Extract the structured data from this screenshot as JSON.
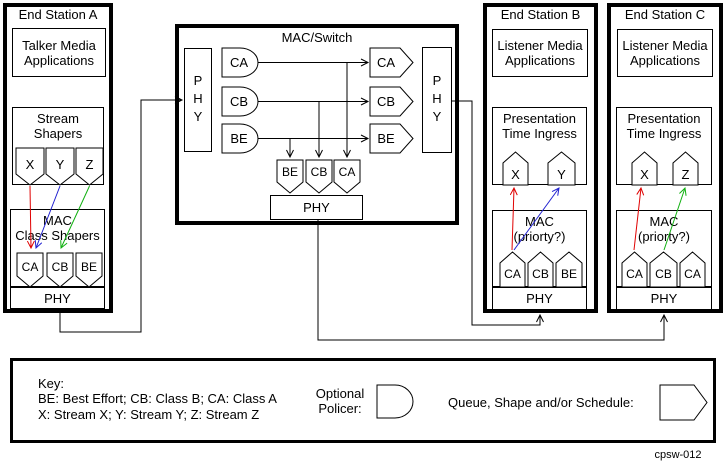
{
  "figure_id": "cpsw-012",
  "colors": {
    "line": "#000000",
    "stream_x_arrow": "#e00000",
    "stream_y_arrow": "#2020d0",
    "stream_z_arrow": "#10b010"
  },
  "station_a": {
    "title": "End Station A",
    "app_lines": [
      "Talker Media",
      "Applications"
    ],
    "shaper_lines": [
      "Stream",
      "Shapers"
    ],
    "streams": [
      "X",
      "Y",
      "Z"
    ],
    "mac_lines": [
      "MAC",
      "Class Shapers"
    ],
    "classes": [
      "CA",
      "CB",
      "BE"
    ],
    "phy_label": "PHY"
  },
  "switch": {
    "title": "MAC/Switch",
    "phy_left_label": "PHY",
    "phy_right_label": "PHY",
    "phy_bottom_label": "PHY",
    "policers": [
      "CA",
      "CB",
      "BE"
    ],
    "right_queues": [
      "CA",
      "CB",
      "BE"
    ],
    "bottom_queues": [
      "BE",
      "CB",
      "CA"
    ]
  },
  "station_b": {
    "title": "End Station B",
    "app_lines": [
      "Listener Media",
      "Applications"
    ],
    "ingress_lines": [
      "Presentation",
      "Time Ingress"
    ],
    "streams": [
      "X",
      "Y"
    ],
    "mac_lines": [
      "MAC",
      "(priorty?)"
    ],
    "classes": [
      "CA",
      "CB",
      "BE"
    ],
    "phy_label": "PHY"
  },
  "station_c": {
    "title": "End Station C",
    "app_lines": [
      "Listener Media",
      "Applications"
    ],
    "ingress_lines": [
      "Presentation",
      "Time Ingress"
    ],
    "streams": [
      "X",
      "Z"
    ],
    "mac_lines": [
      "MAC",
      "(priorty?)"
    ],
    "classes": [
      "CA",
      "CB",
      "CA"
    ],
    "phy_label": "PHY"
  },
  "legend": {
    "title": "Key:",
    "class_key_line": "BE: Best Effort; CB: Class B; CA: Class A",
    "stream_key_line": "X: Stream X; Y: Stream Y; Z: Stream Z",
    "policer_lines": [
      "Optional",
      "Policer:"
    ],
    "queue_label": "Queue, Shape and/or Schedule:"
  }
}
